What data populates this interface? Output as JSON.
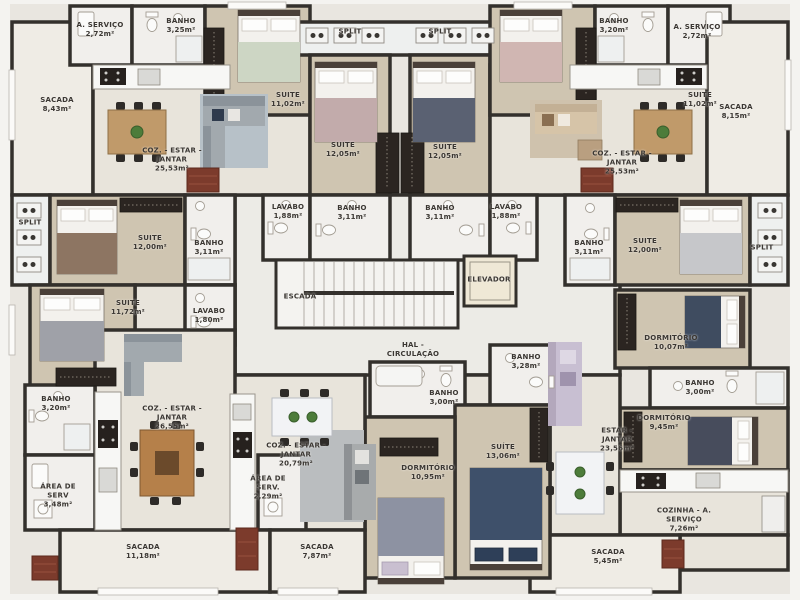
{
  "colors": {
    "wall": "#33302c",
    "wood_floor": "#cfc5b1",
    "tile_floor": "#f1efec",
    "living_floor": "#e8e4db",
    "balcony_floor": "#efece5",
    "hall_floor": "#ecebe6",
    "plant_green": "#4d7c3a",
    "brick_red": "#7c3b2c"
  },
  "rooms": [
    {
      "name": "sacada-top-left",
      "lines": [
        "SACADA"
      ],
      "area": "8,43m²",
      "x": 57,
      "y": 105
    },
    {
      "name": "area-servico-top-left",
      "lines": [
        "A. SERVIÇO"
      ],
      "area": "2,72m²",
      "x": 100,
      "y": 30
    },
    {
      "name": "banho-top-left",
      "lines": [
        "BANHO"
      ],
      "area": "3,25m²",
      "x": 181,
      "y": 26
    },
    {
      "name": "coz-estar-jantar-top-left",
      "lines": [
        "COZ. - ESTAR -",
        "JANTAR"
      ],
      "area": "25,53m²",
      "x": 172,
      "y": 160
    },
    {
      "name": "suite-11-top-left",
      "lines": [
        "SUITE"
      ],
      "area": "11,02m²",
      "x": 288,
      "y": 100
    },
    {
      "name": "suite-12-top-left",
      "lines": [
        "SUITE"
      ],
      "area": "12,05m²",
      "x": 343,
      "y": 150
    },
    {
      "name": "split-top-left",
      "lines": [
        "SPLIT"
      ],
      "x": 350,
      "y": 32
    },
    {
      "name": "split-top-right",
      "lines": [
        "SPLIT"
      ],
      "x": 440,
      "y": 32
    },
    {
      "name": "suite-12-top-right",
      "lines": [
        "SUITE"
      ],
      "area": "12,05m²",
      "x": 445,
      "y": 152
    },
    {
      "name": "suite-11-top-right",
      "lines": [
        "SUITE"
      ],
      "area": "11,02m²",
      "x": 700,
      "y": 100
    },
    {
      "name": "banho-top-right",
      "lines": [
        "BANHO"
      ],
      "area": "3,20m²",
      "x": 614,
      "y": 26
    },
    {
      "name": "area-servico-top-right",
      "lines": [
        "A. SERVIÇO"
      ],
      "area": "2,72m²",
      "x": 697,
      "y": 32
    },
    {
      "name": "sacada-top-right",
      "lines": [
        "SACADA"
      ],
      "area": "8,15m²",
      "x": 736,
      "y": 112
    },
    {
      "name": "coz-estar-jantar-top-right",
      "lines": [
        "COZ. - ESTAR -",
        "JANTAR"
      ],
      "area": "25,53m²",
      "x": 622,
      "y": 163
    },
    {
      "name": "split-mid-left",
      "lines": [
        "SPLIT"
      ],
      "x": 30,
      "y": 223
    },
    {
      "name": "suite-12-mid-left",
      "lines": [
        "SUITE"
      ],
      "area": "12,00m²",
      "x": 150,
      "y": 243
    },
    {
      "name": "banho-mid-left",
      "lines": [
        "BANHO"
      ],
      "area": "3,11m²",
      "x": 209,
      "y": 248
    },
    {
      "name": "suite-11-72",
      "lines": [
        "SUITE"
      ],
      "area": "11,72m²",
      "x": 128,
      "y": 308
    },
    {
      "name": "lavabo-mid-left",
      "lines": [
        "LAVABO"
      ],
      "area": "1,80m²",
      "x": 209,
      "y": 316
    },
    {
      "name": "lavabo-core-left",
      "lines": [
        "LAVABO"
      ],
      "area": "1,88m²",
      "x": 288,
      "y": 212
    },
    {
      "name": "banho-core-left",
      "lines": [
        "BANHO"
      ],
      "area": "3,11m²",
      "x": 352,
      "y": 213
    },
    {
      "name": "banho-core-right",
      "lines": [
        "BANHO"
      ],
      "area": "3,11m²",
      "x": 440,
      "y": 213
    },
    {
      "name": "lavabo-core-right",
      "lines": [
        "LAVABO"
      ],
      "area": "1,88m²",
      "x": 506,
      "y": 212
    },
    {
      "name": "escada",
      "lines": [
        "ESCADA"
      ],
      "x": 300,
      "y": 297
    },
    {
      "name": "elevador",
      "lines": [
        "ELEVADOR"
      ],
      "x": 489,
      "y": 280
    },
    {
      "name": "hal-circulacao",
      "lines": [
        "HAL -",
        "CIRCULAÇÃO"
      ],
      "x": 413,
      "y": 350
    },
    {
      "name": "banho-mid-right",
      "lines": [
        "BANHO"
      ],
      "area": "3,11m²",
      "x": 589,
      "y": 248
    },
    {
      "name": "suite-12-mid-right",
      "lines": [
        "SUITE"
      ],
      "area": "12,00m²",
      "x": 645,
      "y": 246
    },
    {
      "name": "split-mid-right",
      "lines": [
        "SPLIT"
      ],
      "x": 762,
      "y": 248
    },
    {
      "name": "dormitorio-10-07",
      "lines": [
        "DORMITÓRIO"
      ],
      "area": "10,07m²",
      "x": 671,
      "y": 343
    },
    {
      "name": "banho-right-3-00",
      "lines": [
        "BANHO"
      ],
      "area": "3,00m²",
      "x": 700,
      "y": 388
    },
    {
      "name": "dormitorio-9-45",
      "lines": [
        "DORMITÓRIO"
      ],
      "area": "9,45m²",
      "x": 664,
      "y": 423
    },
    {
      "name": "banho-center-3-28",
      "lines": [
        "BANHO"
      ],
      "area": "3,28m²",
      "x": 526,
      "y": 362
    },
    {
      "name": "banho-center-3-00",
      "lines": [
        "BANHO"
      ],
      "area": "3,00m²",
      "x": 444,
      "y": 398
    },
    {
      "name": "suite-13-06",
      "lines": [
        "SUÍTE"
      ],
      "area": "13,06m²",
      "x": 503,
      "y": 452
    },
    {
      "name": "banho-bottom-left",
      "lines": [
        "BANHO"
      ],
      "area": "3,20m²",
      "x": 56,
      "y": 404
    },
    {
      "name": "coz-estar-jantar-bottom-left",
      "lines": [
        "COZ. - ESTAR -",
        "JANTAR"
      ],
      "area": "26,55m²",
      "x": 172,
      "y": 418
    },
    {
      "name": "area-de-serv-bottom-left",
      "lines": [
        "ÁREA DE",
        "SERV"
      ],
      "area": "3,48m²",
      "x": 58,
      "y": 496
    },
    {
      "name": "sacada-11-18",
      "lines": [
        "SACADA"
      ],
      "area": "11,18m²",
      "x": 143,
      "y": 552
    },
    {
      "name": "coz-estar-jantar-bottom-mid",
      "lines": [
        "COZ. - ESTAR -",
        "JANTAR"
      ],
      "area": "20,79m²",
      "x": 296,
      "y": 455
    },
    {
      "name": "area-de-serv-bottom-mid",
      "lines": [
        "ÁREA DE",
        "SERV."
      ],
      "area": "2,29m²",
      "x": 268,
      "y": 488
    },
    {
      "name": "sacada-7-87",
      "lines": [
        "SACADA"
      ],
      "area": "7,87m²",
      "x": 317,
      "y": 552
    },
    {
      "name": "dormitorio-10-95",
      "lines": [
        "DORMITÓRIO"
      ],
      "area": "10,95m²",
      "x": 428,
      "y": 473
    },
    {
      "name": "estar-jantar-bottom-right",
      "lines": [
        "ESTAR -",
        "JANTAR"
      ],
      "area": "23,56m²",
      "x": 617,
      "y": 440
    },
    {
      "name": "cozinha-a-servico",
      "lines": [
        "COZINHA - A.",
        "SERVIÇO"
      ],
      "area": "7,26m²",
      "x": 684,
      "y": 520
    },
    {
      "name": "sacada-5-45",
      "lines": [
        "SACADA"
      ],
      "area": "5,45m²",
      "x": 608,
      "y": 557
    }
  ]
}
